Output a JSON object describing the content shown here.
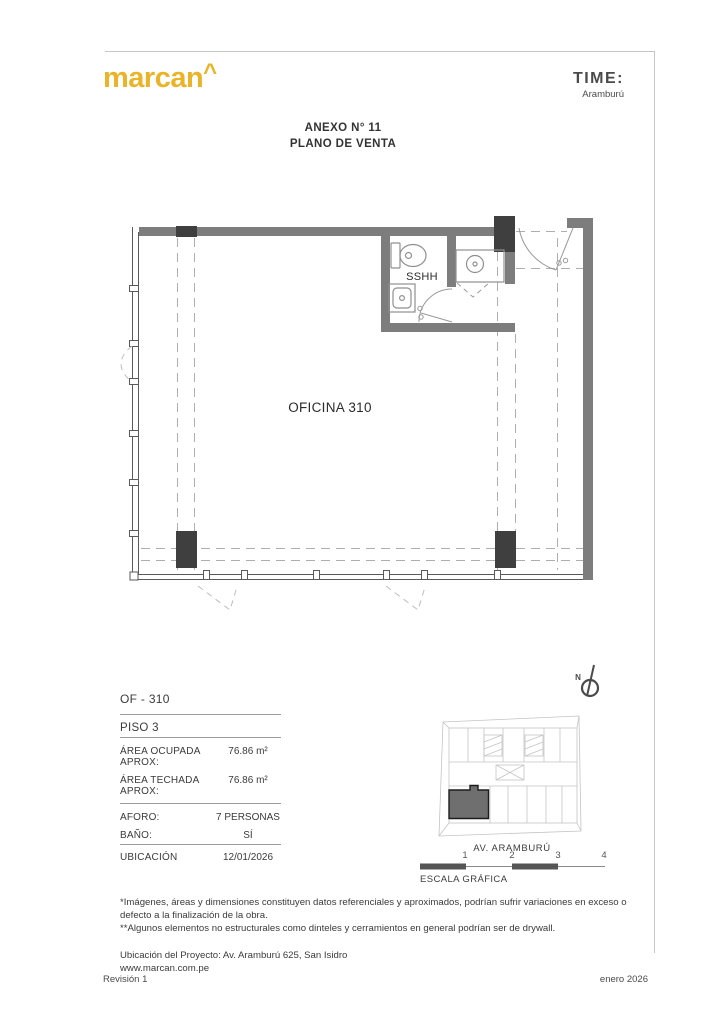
{
  "header": {
    "logo": "marcan",
    "logo_caret": "^",
    "brand": "TIME:",
    "brand_sub": "Aramburú"
  },
  "title": {
    "line1": "ANEXO N° 11",
    "line2": "PLANO DE VENTA"
  },
  "plan": {
    "room_label": "OFICINA 310",
    "bath_label": "SSHH"
  },
  "info": {
    "unit": "OF - 310",
    "floor": "PISO 3",
    "rows": [
      {
        "label": "ÁREA OCUPADA APROX:",
        "value": "76.86 m²"
      },
      {
        "label": "ÁREA TECHADA APROX:",
        "value": "76.86 m²"
      }
    ],
    "rows2": [
      {
        "label": "AFORO:",
        "value": "7 PERSONAS"
      },
      {
        "label": "BAÑO:",
        "value": "SÍ"
      }
    ],
    "location_label": "UBICACIÓN",
    "location_value": "12/01/2026"
  },
  "map": {
    "north": "N",
    "street": "AV. ARAMBURÚ",
    "scale_label": "ESCALA GRÁFICA",
    "scale_ticks": [
      "1",
      "2",
      "3",
      "4"
    ]
  },
  "notes": {
    "note1": "*Imágenes, áreas y dimensiones constituyen datos referenciales y aproximados, podrían sufrir variaciones en exceso o defecto a la finalización de la obra.",
    "note2": "**Algunos elementos no estructurales como dinteles y cerramientos en general podrían ser de drywall.",
    "address": "Ubicación del Proyecto: Av. Aramburú 625, San Isidro",
    "website": "www.marcan.com.pe"
  },
  "footer": {
    "left": "Revisión 1",
    "right": "enero 2026"
  },
  "colors": {
    "brand_yellow": "#e9b427",
    "wall_gray": "#7d7d7d",
    "column_dark": "#3f3f3f",
    "highlight_unit": "#6f6f6f"
  }
}
